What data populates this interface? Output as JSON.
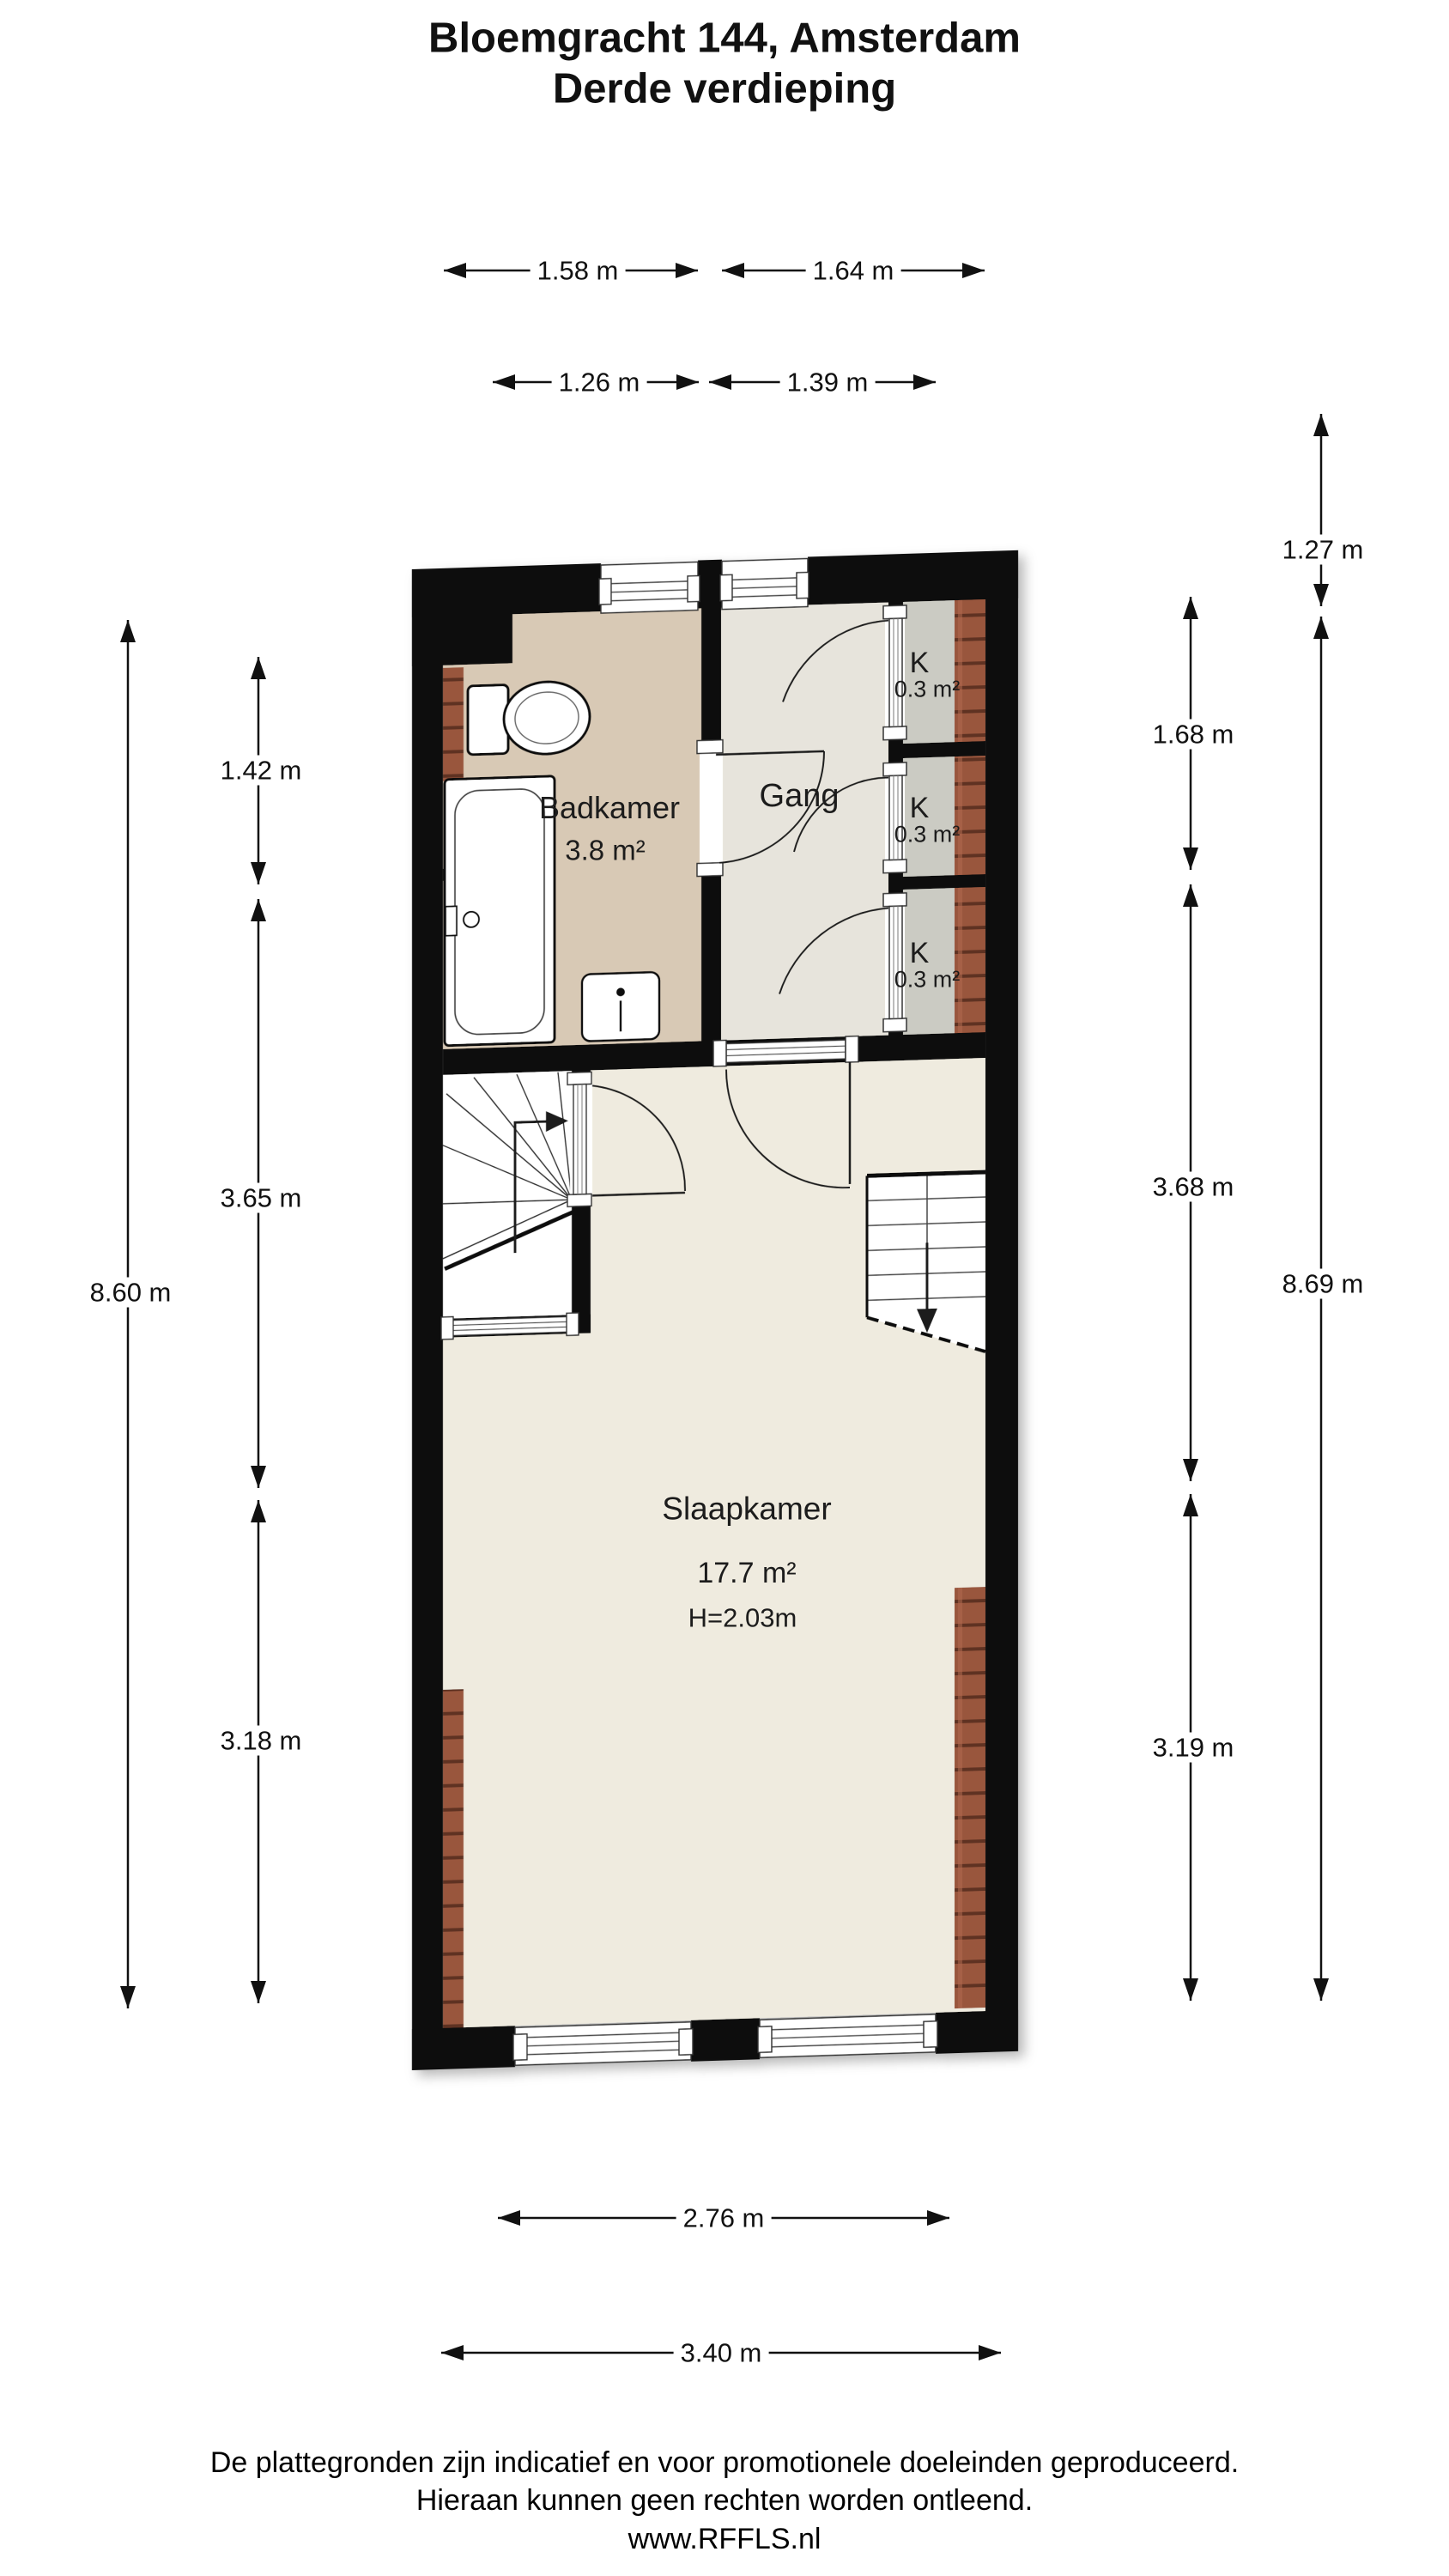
{
  "title": {
    "line1": "Bloemgracht 144, Amsterdam",
    "line2": "Derde verdieping"
  },
  "rooms": {
    "badkamer": {
      "name": "Badkamer",
      "area": "3.8 m²"
    },
    "gang": {
      "name": "Gang"
    },
    "closets": [
      {
        "name": "K",
        "area": "0.3 m²"
      },
      {
        "name": "K",
        "area": "0.3 m²"
      },
      {
        "name": "K",
        "area": "0.3 m²"
      }
    ],
    "slaapkamer": {
      "name": "Slaapkamer",
      "area": "17.7 m²",
      "ceiling_height": "H=2.03m"
    }
  },
  "dimensions": {
    "top_outer": [
      "1.58 m",
      "1.64 m"
    ],
    "top_inner": [
      "1.26 m",
      "1.39 m"
    ],
    "left_inner": [
      "1.42 m",
      "3.65 m",
      "3.18 m"
    ],
    "left_outer": "8.60 m",
    "right_inner": [
      "1.68 m",
      "3.68 m",
      "3.19 m"
    ],
    "right_outer_upper": "1.27 m",
    "right_outer": "8.69 m",
    "bottom_inner": "2.76 m",
    "bottom_outer": "3.40 m"
  },
  "footer": {
    "line1": "De plattegronden zijn indicatief en voor promotionele doeleinden geproduceerd.",
    "line2": "Hieraan kunnen geen rechten worden ontleend.",
    "line3": "www.RFFLS.nl"
  },
  "colors": {
    "wall": "#0c0c0c",
    "badkamer_floor": "#d8c9b5",
    "gang_floor": "#e7e4dc",
    "slaapkamer_floor": "#efebdf",
    "closet_floor": "#cbcbc3",
    "brick": "#99563e",
    "brick_line": "#5f3323",
    "line": "#1a1a1a"
  }
}
